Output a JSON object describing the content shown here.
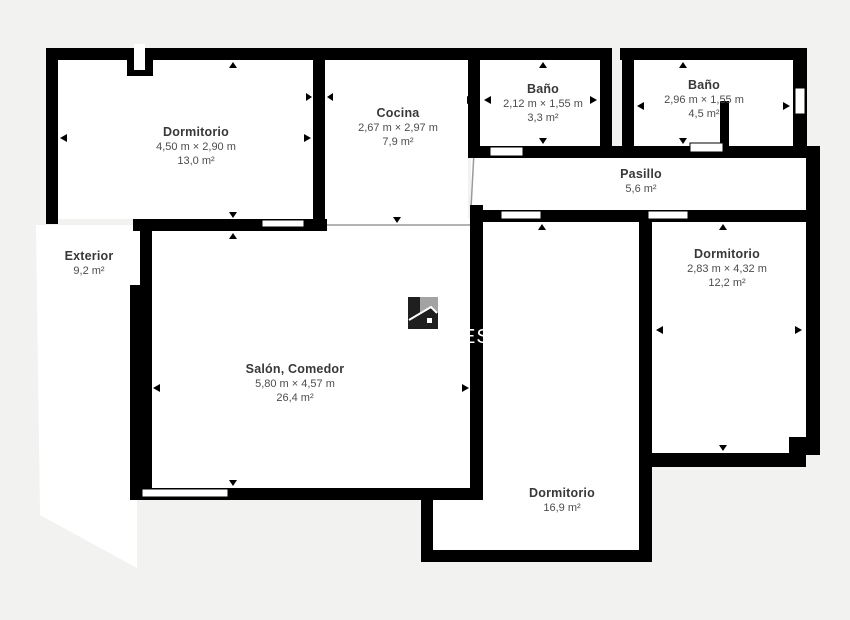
{
  "plan": {
    "type": "floor-plan",
    "language": "es",
    "colors": {
      "background": "#f2f2f0",
      "walls": "#000000",
      "room_fill": "#ffffff",
      "label_text": "#3d3d3d",
      "open_boundary_line": "#9a9a9a"
    },
    "watermark": {
      "visible_text": "ES",
      "logo": "house-logo"
    }
  },
  "rooms": [
    {
      "name": "Dormitorio",
      "dimensions": "4,50 m × 2,90 m",
      "area": "13,0 m²"
    },
    {
      "name": "Cocina",
      "dimensions": "2,67 m × 2,97 m",
      "area": "7,9 m²"
    },
    {
      "name": "Baño",
      "dimensions": "2,12 m × 1,55 m",
      "area": "3,3 m²"
    },
    {
      "name": "Baño",
      "dimensions": "2,96 m × 1,55 m",
      "area": "4,5 m²"
    },
    {
      "name": "Pasillo",
      "dimensions": "",
      "area": "5,6 m²"
    },
    {
      "name": "Dormitorio",
      "dimensions": "2,83 m × 4,32 m",
      "area": "12,2 m²"
    },
    {
      "name": "Exterior",
      "dimensions": "",
      "area": "9,2 m²"
    },
    {
      "name": "Salón, Comedor",
      "dimensions": "5,80 m × 4,57 m",
      "area": "26,4 m²"
    },
    {
      "name": "Dormitorio",
      "dimensions": "",
      "area": "16,9 m²"
    }
  ]
}
